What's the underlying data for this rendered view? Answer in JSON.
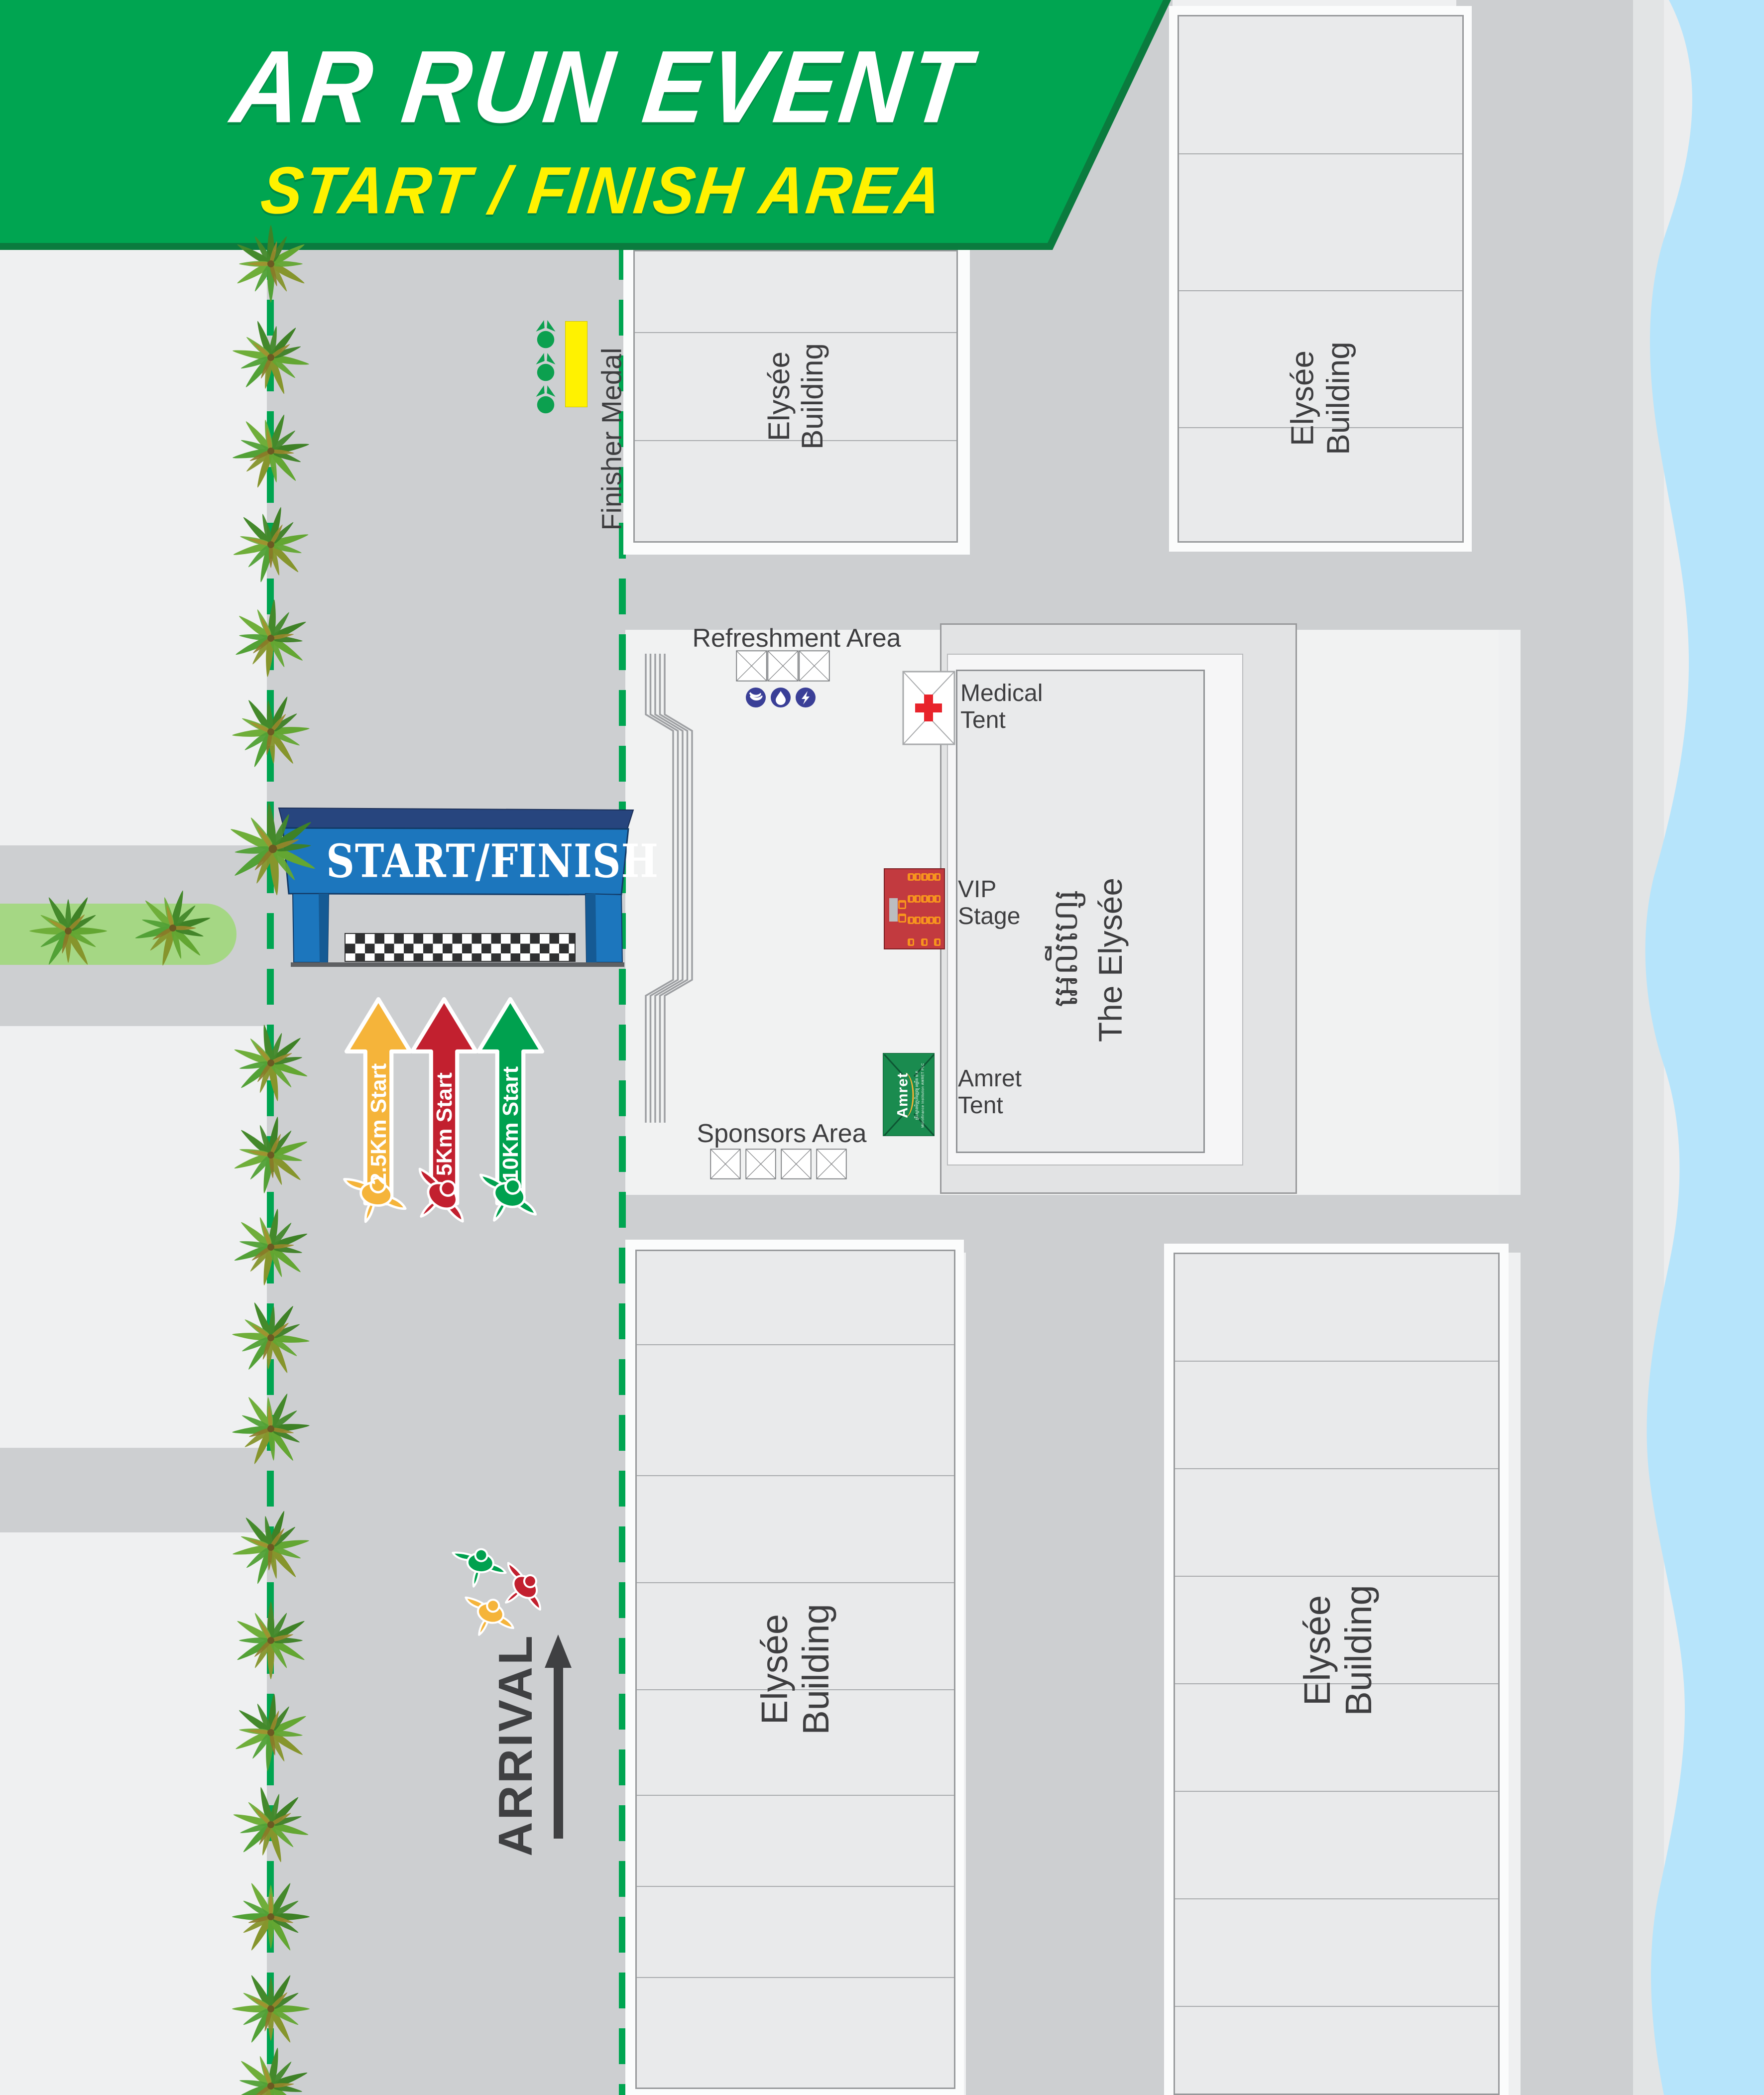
{
  "header": {
    "title": "AR RUN EVENT",
    "subtitle": "START / FINISH AREA"
  },
  "gate": {
    "label": "START/FINISH"
  },
  "route_arrows": [
    {
      "label": "2.5Km Start",
      "color": "#F5B43A"
    },
    {
      "label": "5Km Start",
      "color": "#C2202F"
    },
    {
      "label": "10Km Start",
      "color": "#00A14F"
    }
  ],
  "buildings": {
    "label_line1": "Elysée",
    "label_line2": "Building"
  },
  "elysee_complex": {
    "khmer_name": "អេលីហ្សេ",
    "english_name": "The Elysée"
  },
  "areas": {
    "finisher_medal": "Finisher Medal",
    "refreshment": "Refreshment Area",
    "medical_line1": "Medical",
    "medical_line2": "Tent",
    "vip_line1": "VIP",
    "vip_line2": "Stage",
    "amret_line1": "Amret",
    "amret_line2": "Tent",
    "sponsors": "Sponsors Area",
    "arrival": "ARRIVAL"
  },
  "amret_tent": {
    "logo": "Amret",
    "khmer_small": "គ្រឹះស្ថានមីក្រូហិរញ្ញវត្ថុ អម្រឹត ម.ក",
    "sub": "Microfinance Institution AMRET PLC"
  },
  "colors": {
    "banner_green": "#00A551",
    "banner_green_dark": "#0A7B3E",
    "subtitle_yellow": "#FFF200",
    "road_gray": "#CDCFD1",
    "background": "#EFF0F1",
    "building_fill": "#E9EAEB",
    "building_border": "#97999B",
    "water_blue": "#B6E4FB",
    "median_green": "#A5D784",
    "dashed_line_green": "#00A551",
    "gate_blue": "#1C76BD",
    "gate_navy": "#27457E",
    "vip_red": "#C23A3F",
    "chair_orange": "#F7941E",
    "amret_green": "#1A8B4F",
    "medical_red": "#E8232B",
    "refreshment_navy": "#3A3F97",
    "finisher_yellow": "#FFF200",
    "text_dark": "#3E3E40"
  },
  "icons": {
    "palm": "palm-tree-icon",
    "runner": "runner-icon",
    "medal": "finisher-medal-icon",
    "banana": "banana-icon",
    "droplet": "water-drop-icon",
    "energy": "electrolyte-icon",
    "red_cross": "red-cross-icon",
    "table": "table-tent-icon",
    "chair": "chair-icon"
  }
}
